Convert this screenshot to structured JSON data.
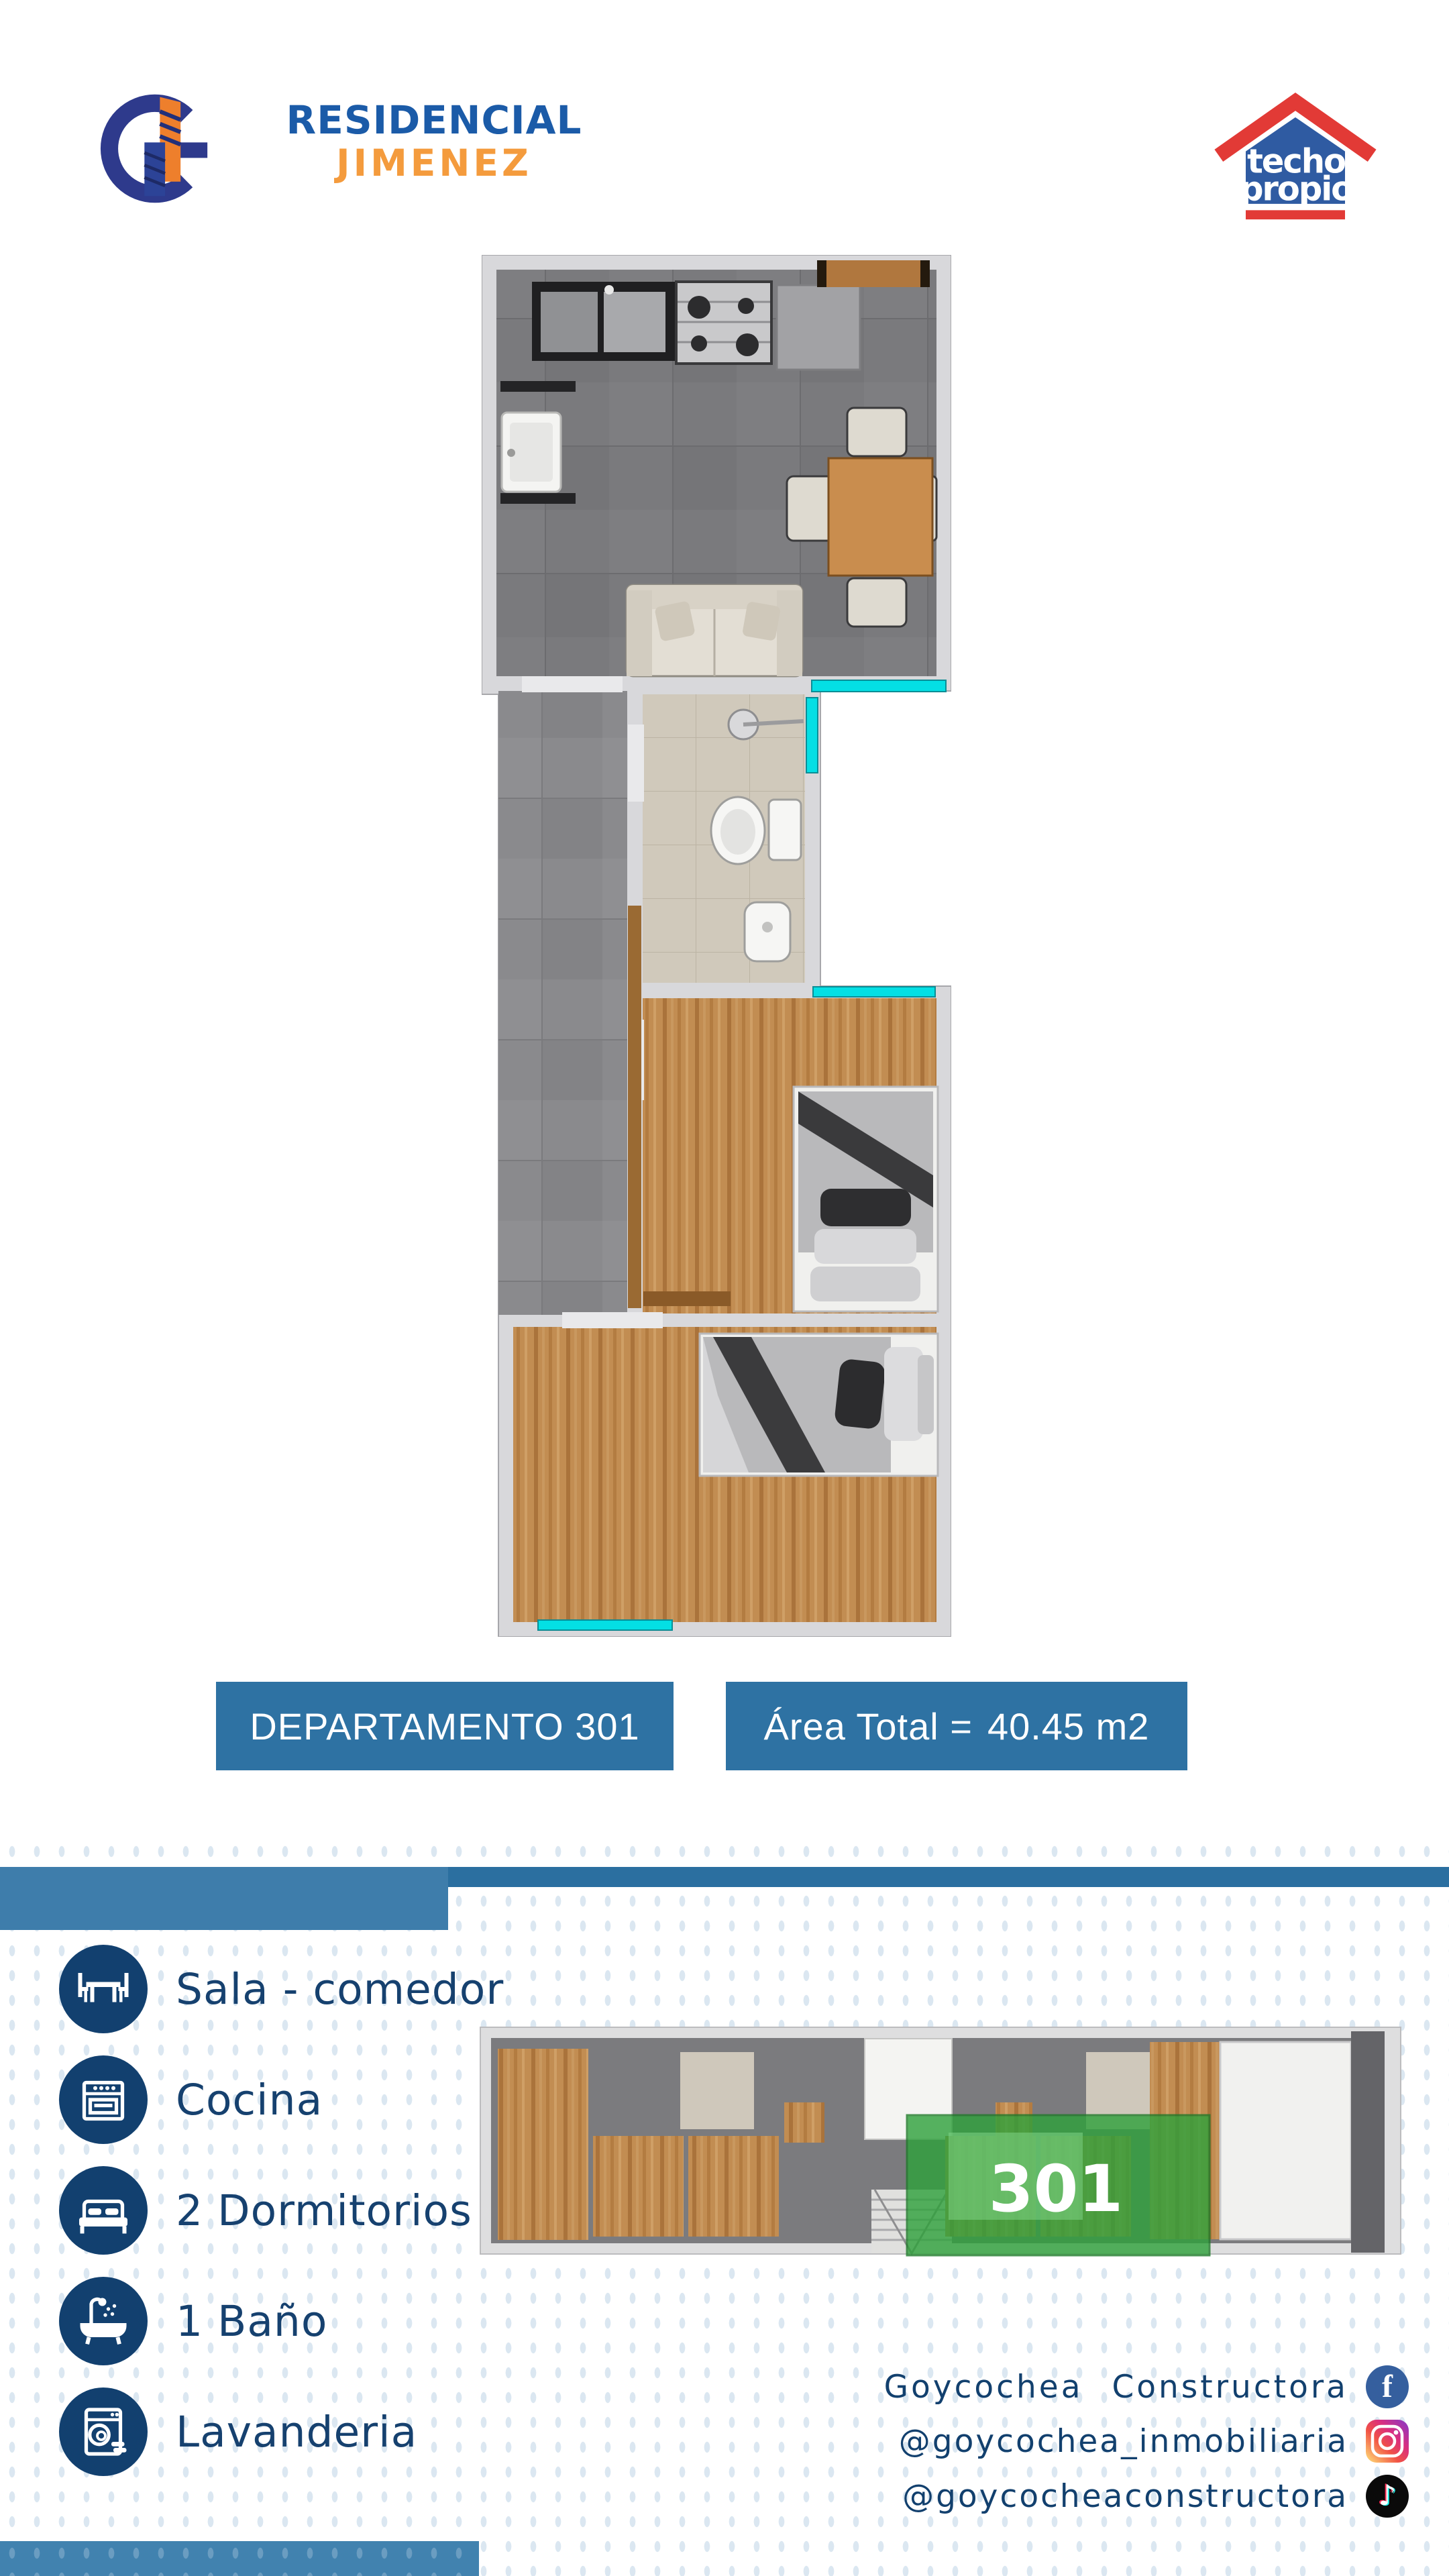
{
  "header": {
    "brand": {
      "monogram": "G",
      "title_line1": "RESIDENCIAL",
      "title_line2": "JIMENEZ"
    },
    "program_logo": {
      "line1": "techo",
      "line2": "propio"
    }
  },
  "unit": {
    "badge_department": "DEPARTAMENTO 301",
    "badge_area_prefix": "Área Total =",
    "badge_area_value": "40.45 m2",
    "area_m2": 40.45,
    "unit_number": "301"
  },
  "features": [
    {
      "icon": "dining-table-icon",
      "label": "Sala - comedor"
    },
    {
      "icon": "stove-icon",
      "label": "Cocina"
    },
    {
      "icon": "bed-icon",
      "label": "2 Dormitorios"
    },
    {
      "icon": "bathtub-icon",
      "label": "1 Baño"
    },
    {
      "icon": "washing-machine-icon",
      "label": "Lavanderia"
    }
  ],
  "overview_plan": {
    "highlight_label": "301",
    "highlight_color": "#2ea13b"
  },
  "social": [
    {
      "network": "facebook",
      "handle": "Goycochea Constructora"
    },
    {
      "network": "instagram",
      "handle": "@goycochea_inmobiliaria"
    },
    {
      "network": "tiktok",
      "handle": "@goycocheaconstructora"
    }
  ],
  "colors": {
    "accent_blue": "#2e72a3",
    "divider_blue": "#3e7dab",
    "navy": "#12406f",
    "brand_blue": "#1b5ba8",
    "brand_orange": "#f49b3d",
    "window_cyan": "#04dfe4",
    "highlight_green": "#2ea13b"
  }
}
